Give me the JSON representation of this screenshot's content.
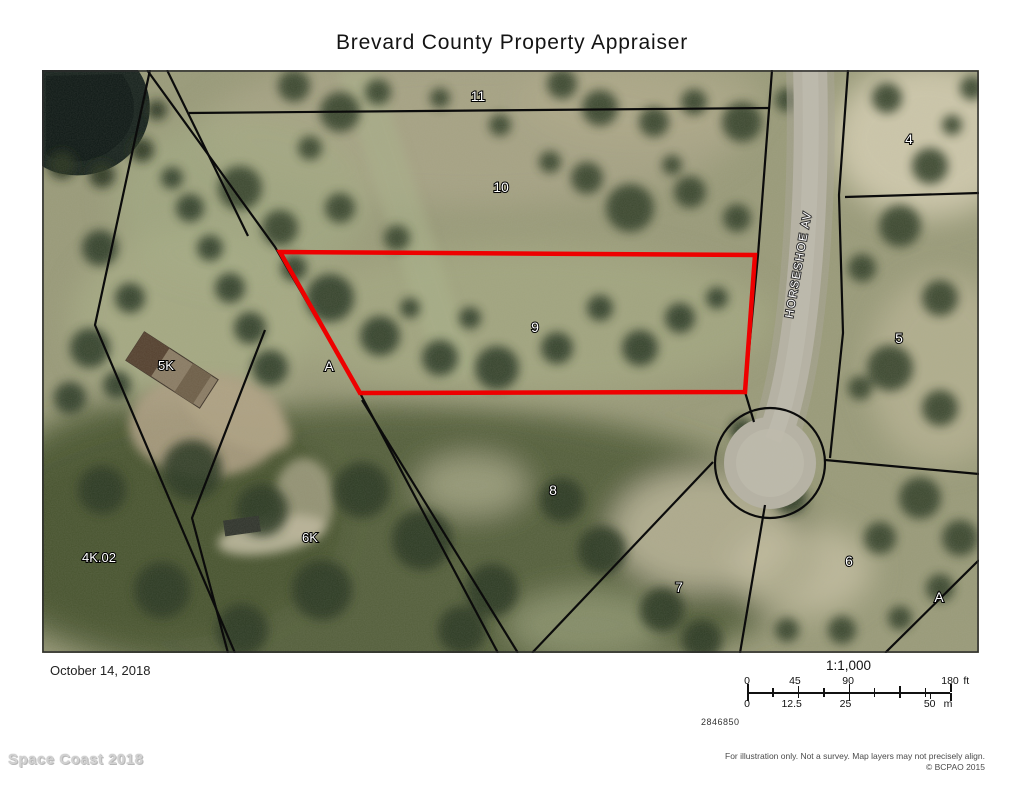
{
  "title": "Brevard County Property Appraiser",
  "map": {
    "road_label": "HORSESHOE AV",
    "highlight_color": "#ee0000",
    "parcel_labels": {
      "lot11": "11",
      "lot10": "10",
      "lot9": "9",
      "lot8": "8",
      "lot7": "7",
      "lot6": "6",
      "lot5": "5",
      "lot4": "4",
      "lot5k": "5K",
      "lot6k": "6K",
      "lot4k02": "4K.02",
      "tractA_west": "A",
      "tractA_east": "A"
    }
  },
  "footer": {
    "date": "October 14, 2018",
    "scale_ratio": "1:1,000",
    "scale_ft": {
      "t0": "0",
      "t1": "45",
      "t2": "90",
      "t3": "180",
      "unit": "ft"
    },
    "scale_m": {
      "t0": "0",
      "t1": "12.5",
      "t2": "25",
      "t3": "50",
      "unit": "m"
    },
    "map_number": "2846850",
    "watermark": "Space Coast 2018",
    "disclaimer": "For illustration only. Not a survey. Map layers may not precisely align.",
    "copyright": "© BCPAO 2015"
  }
}
